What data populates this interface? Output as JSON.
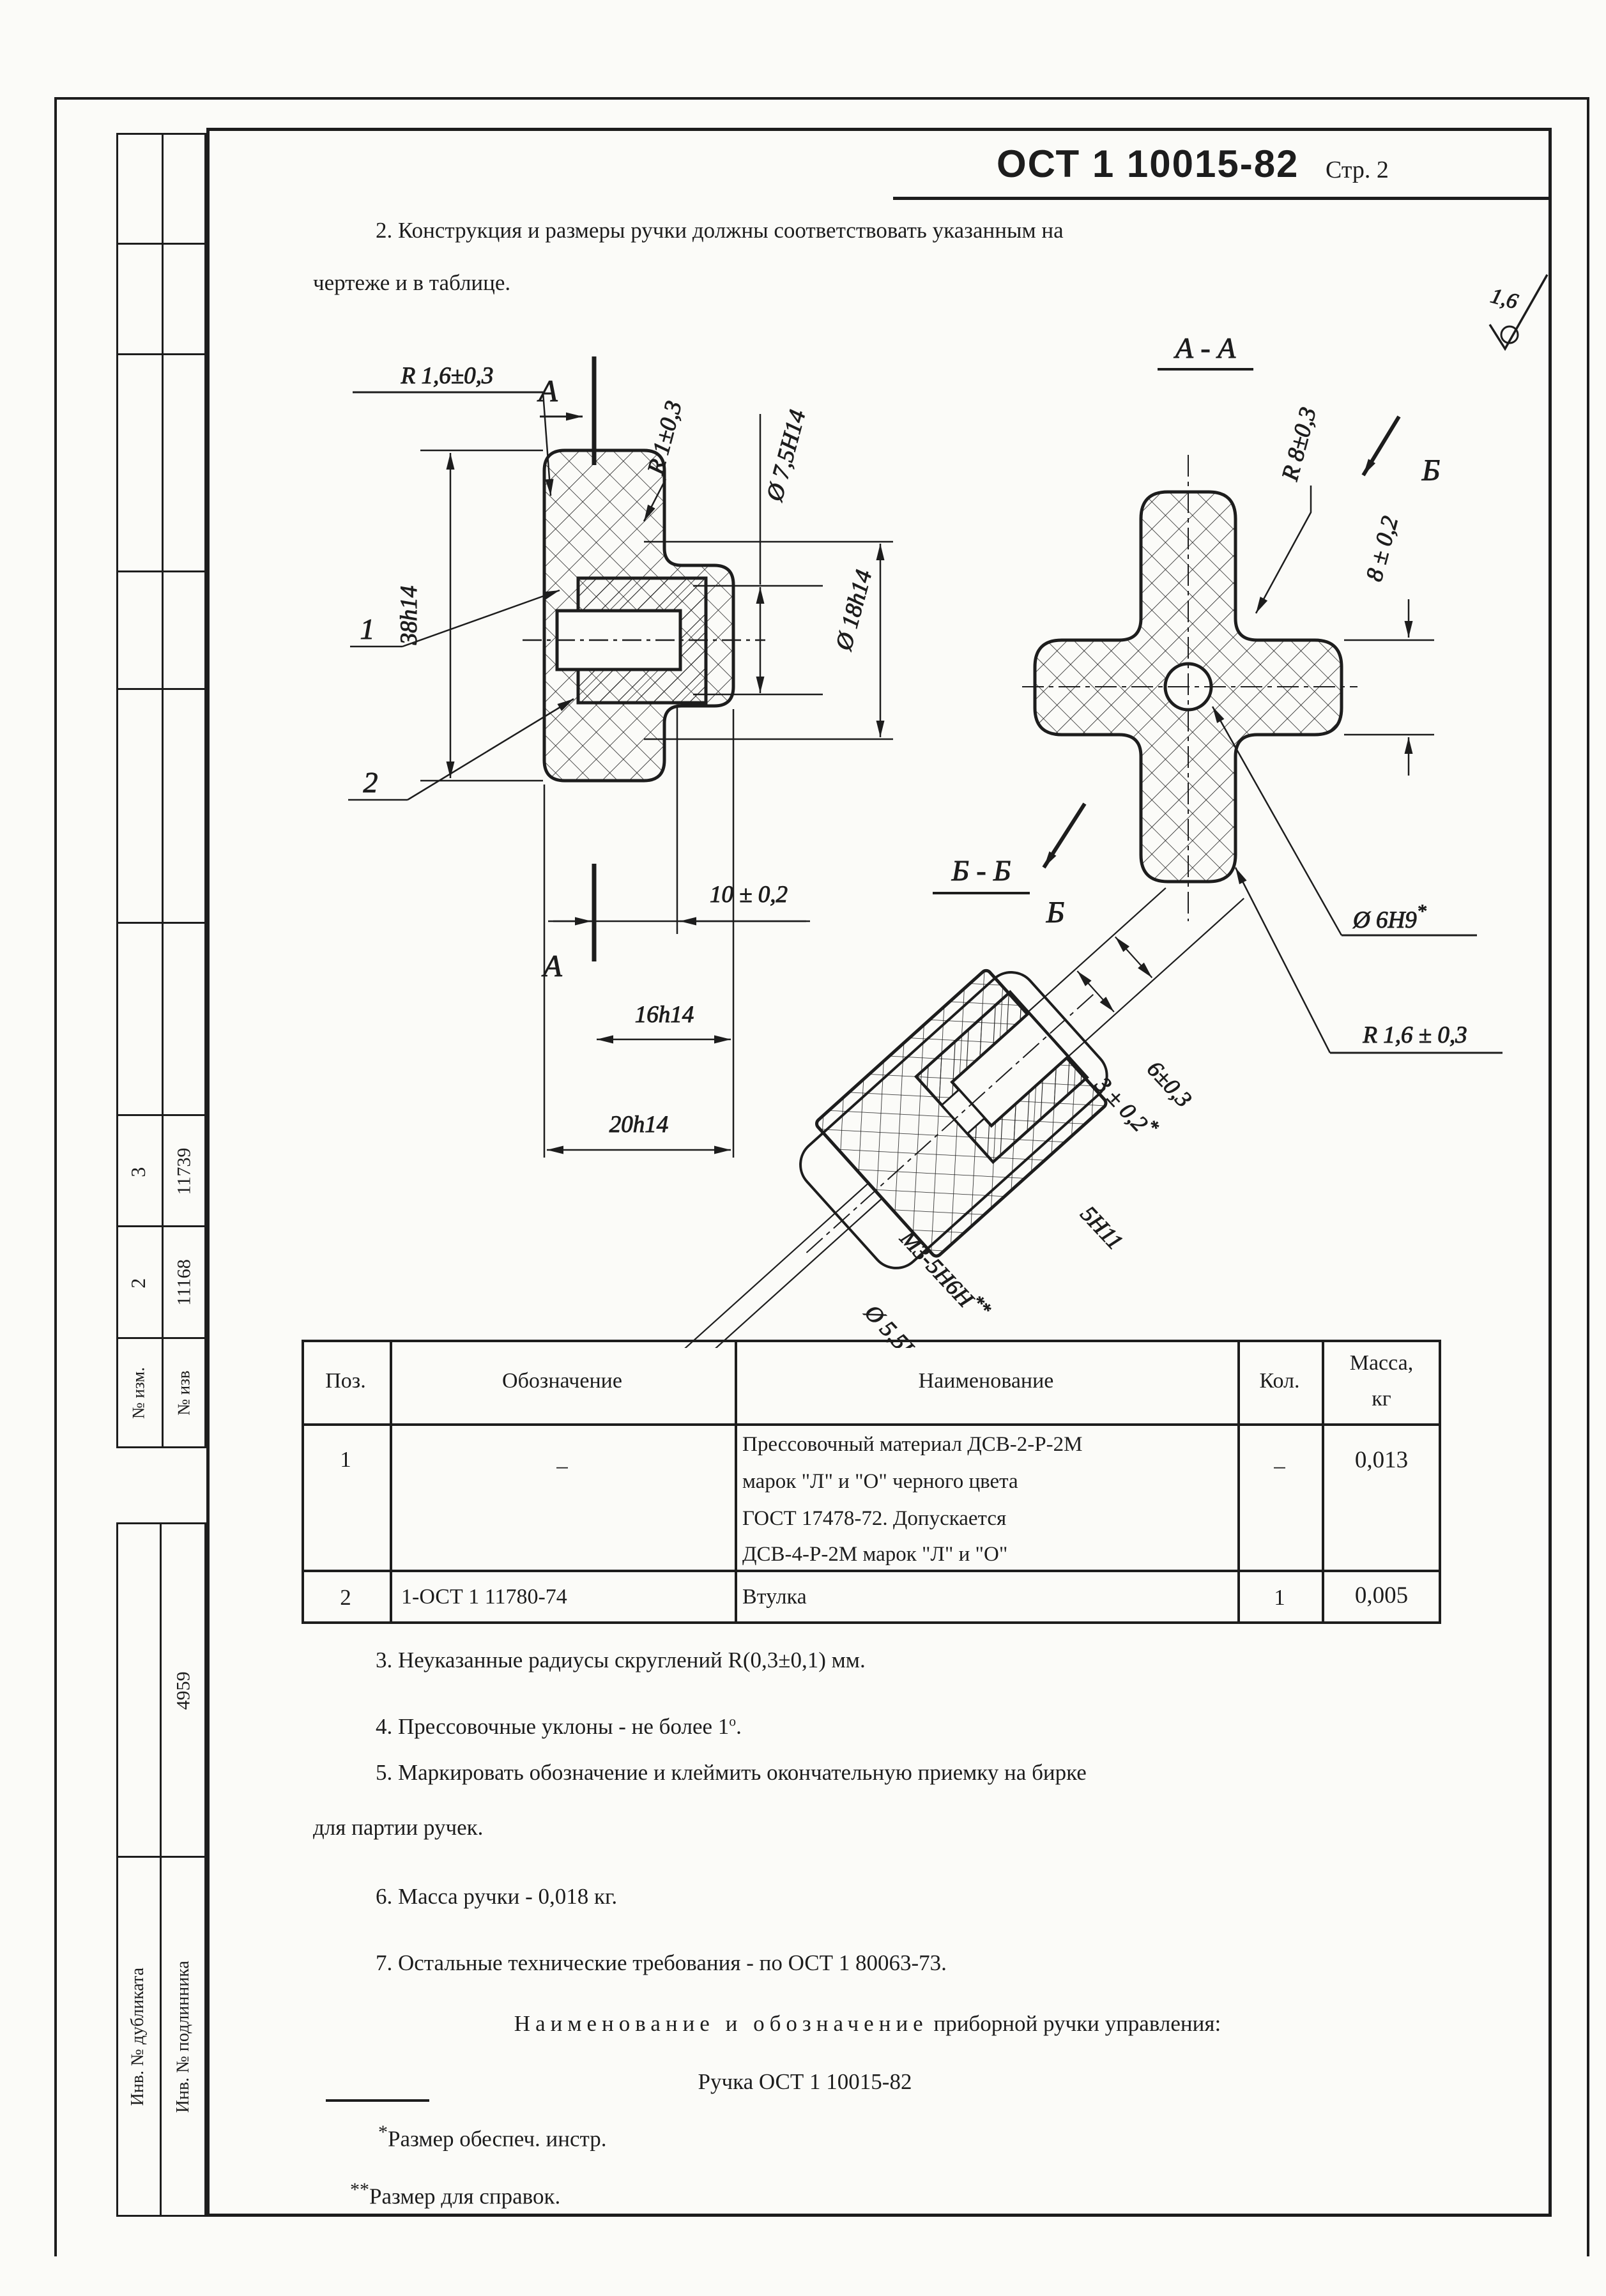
{
  "header": {
    "standard": "ОСТ 1 10015-82",
    "page": "Стр. 2"
  },
  "surface_finish": "1,6",
  "paragraph2": {
    "line1": "2. Конструкция и размеры ручки должны соответствовать указанным на",
    "line2": "чертеже и в таблице."
  },
  "drawing": {
    "front": {
      "radius_top": "R 1,6±0,3",
      "section_letter": "А",
      "radius_hub": "R 1±0,3",
      "dia_bore": "Ø 7,5H14",
      "dia_hub": "Ø 18h14",
      "height": "38h14",
      "pos1": "1",
      "pos2": "2",
      "dim_depth": "10 ± 0,2",
      "dim_16": "16h14",
      "dim_20": "20h14"
    },
    "section_aa": {
      "title": "А - А",
      "radius_lobe": "R 8±0,3",
      "view_letter": "Б",
      "dim_thickness": "8 ± 0,2",
      "dia_hole": "Ø 6Н9",
      "dia_hole_mark": "*",
      "radius_edge": "R 1,6 ± 0,3"
    },
    "section_bb": {
      "title": "Б - Б",
      "dim_6": "6±0,3",
      "dim_3": "3 ± 0,2",
      "dim_3_mark": "*",
      "dim_5": "5Н11",
      "thread": "М3-5Н6Н",
      "thread_mark": "**",
      "dia_55": "Ø 5,5Н14"
    }
  },
  "table": {
    "headers": {
      "pos": "Поз.",
      "designation": "Обозначение",
      "name": "Наименование",
      "qty": "Кол.",
      "mass_l1": "Масса,",
      "mass_l2": "кг"
    },
    "rows": [
      {
        "pos": "1",
        "designation": "–",
        "name_lines": [
          "Прессовочный материал ДСВ-2-Р-2М",
          "марок \"Л\" и \"О\" черного цвета",
          "ГОСТ 17478-72. Допускается",
          "ДСВ-4-Р-2М марок \"Л\" и \"О\""
        ],
        "qty": "–",
        "mass": "0,013"
      },
      {
        "pos": "2",
        "designation": "1-ОСТ 1 11780-74",
        "name": "Втулка",
        "qty": "1",
        "mass": "0,005"
      }
    ]
  },
  "notes": {
    "n3": "3. Неуказанные радиусы скруглений R(0,3±0,1) мм.",
    "n4_pre": "4. Прессовочные уклоны - не более 1",
    "n4_sup": "о",
    "n4_post": ".",
    "n5_line1": "5. Маркировать обозначение и клеймить окончательную приемку на бирке",
    "n5_line2": "для партии ручек.",
    "n6": "6. Масса ручки - 0,018 кг.",
    "n7": "7. Остальные технические требования - по ОСТ 1 80063-73."
  },
  "naming": {
    "intro_spaced": "Наименование и обозначение",
    "intro_rest": " приборной ручки управления:",
    "designation": "Ручка ОСТ 1 10015-82"
  },
  "footnotes": {
    "mark1": "*",
    "text1": "Размер обеспеч. инстр.",
    "mark2": "**",
    "text2": "Размер для справок."
  },
  "sidebar": {
    "col_izm_label": "№ изм.",
    "col_izv_label": "№ изв",
    "izm_row2": "2",
    "izm_row3": "3",
    "izv_row2": "11168",
    "izv_row3": "11739",
    "doc_number": "4959",
    "inv_dup": "Инв. № дубликата",
    "inv_orig": "Инв. № подлинника"
  }
}
